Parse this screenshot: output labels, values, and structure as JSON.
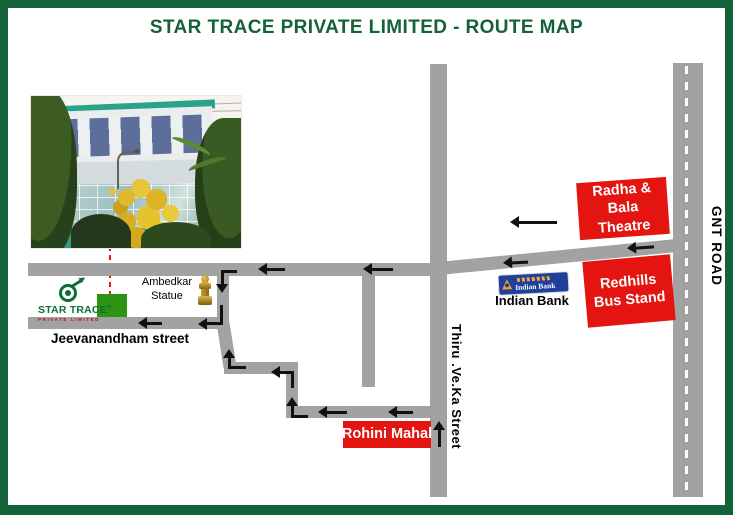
{
  "title": "STAR TRACE PRIVATE LIMITED - ROUTE MAP",
  "logo": {
    "name": "STAR TRACE",
    "mark": "®",
    "subtitle": "PRIVATE LIMITED"
  },
  "streets": {
    "jeevanandham": "Jeevanandham street",
    "thiru": "Thiru .Ve.Ka Street",
    "gnt": "GNT ROAD"
  },
  "landmarks": {
    "ambedkar": "Ambedkar\nStatue",
    "indian_bank": "Indian Bank",
    "theatre": "Radha & Bala\nTheatre",
    "bus_stand": "Redhills\nBus Stand",
    "rohini": "Rohini Mahal"
  },
  "bank_logo_text": "Indian Bank",
  "colors": {
    "border_green": "#15613a",
    "road_gray": "#a2a2a2",
    "landmark_red": "#e41410",
    "location_green": "#2e9212",
    "logo_green": "#0c7038",
    "bank_blue": "#1e3f9a",
    "statue_gold": "#c9a23a",
    "route_dash_red": "#ee1111",
    "arrow_black": "#111111"
  }
}
